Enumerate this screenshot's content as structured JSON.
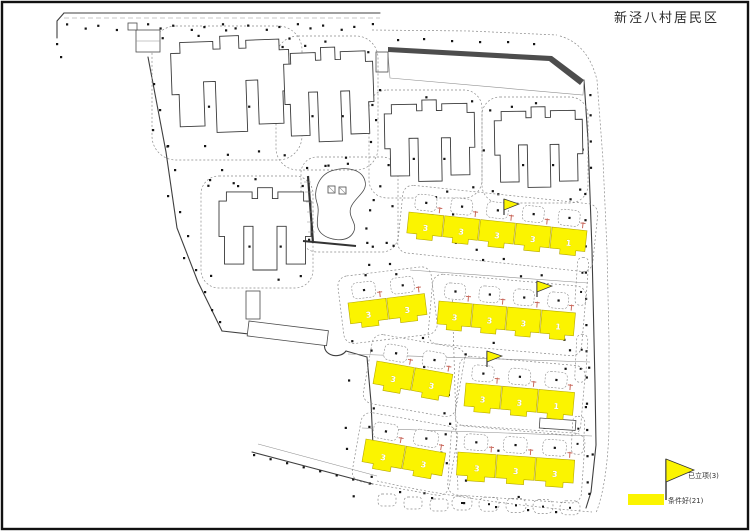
{
  "page": {
    "title": "新泾八村居民区"
  },
  "legend": {
    "flag_item": {
      "label": "已立项(3)"
    },
    "highlight_item": {
      "label": "条件好(21)"
    }
  },
  "colors": {
    "highlight": "#FBF400",
    "flag": "#FBF400",
    "entrance": "#C96A5E",
    "outline": "#3a3a3a"
  },
  "map": {
    "flags_on_map": 3,
    "rows": [
      {
        "name": "row-1",
        "segments": [
          "3",
          "3",
          "3",
          "3",
          "1"
        ]
      },
      {
        "name": "row-2-left",
        "segments": [
          "3",
          "3"
        ]
      },
      {
        "name": "row-2-right",
        "segments": [
          "3",
          "3",
          "3",
          "1"
        ]
      },
      {
        "name": "row-3-left",
        "segments": [
          "3",
          "3"
        ]
      },
      {
        "name": "row-3-right",
        "segments": [
          "3",
          "3",
          "1"
        ]
      },
      {
        "name": "row-4-left",
        "segments": [
          "3",
          "3"
        ]
      },
      {
        "name": "row-4-right",
        "segments": [
          "3",
          "3",
          "3"
        ]
      }
    ]
  }
}
